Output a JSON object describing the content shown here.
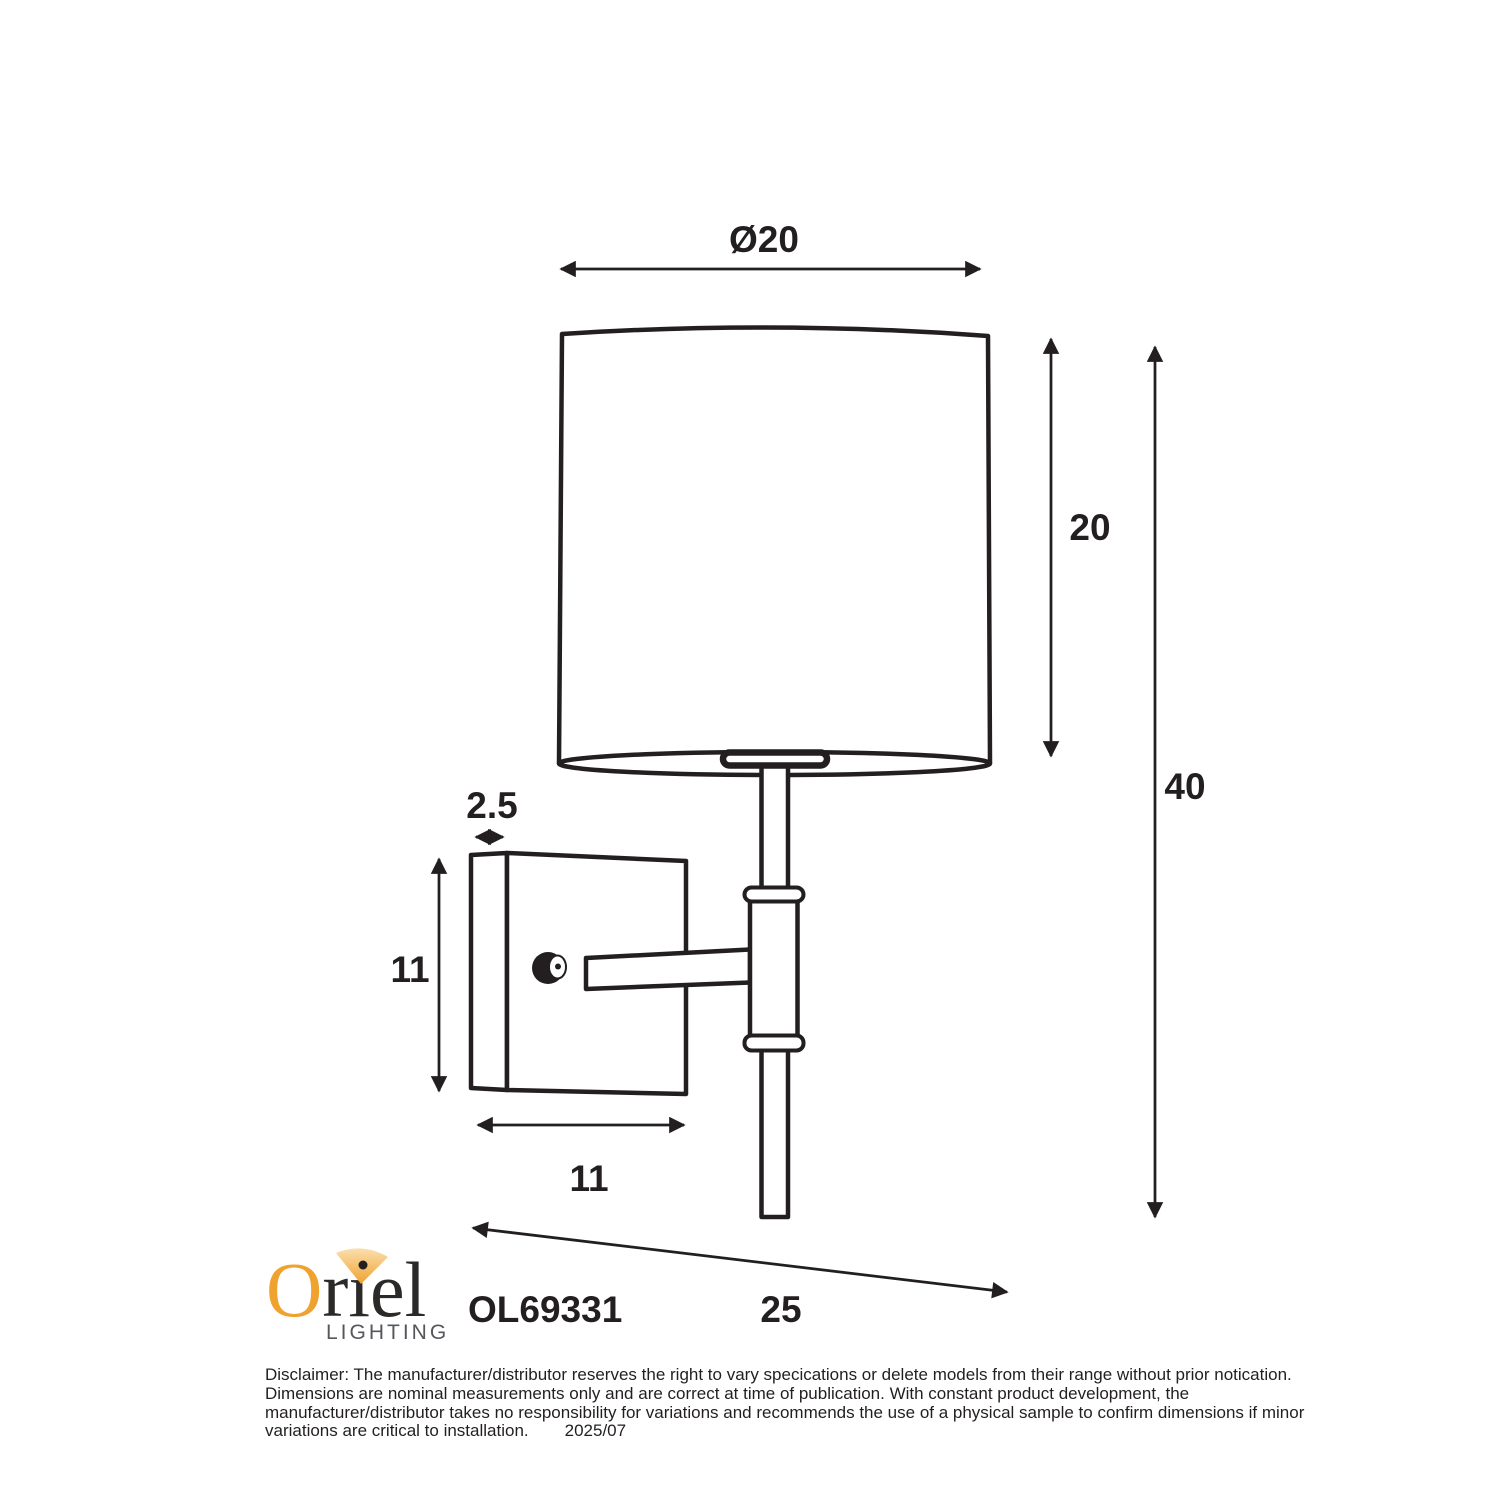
{
  "colors": {
    "ink": "#231F20",
    "background": "#FFFFFF",
    "logo_orange": "#F0A22F",
    "logo_dark": "#2B2A29",
    "logo_gray": "#56575B",
    "cone_light": "#FBDFAE",
    "cone_deep": "#F0A22F"
  },
  "labels": {
    "shade_diameter": "Ø20",
    "shade_height": "20",
    "overall_height": "40",
    "plate_depth": "2.5",
    "plate_height": "11",
    "plate_width": "11",
    "projection": "25"
  },
  "product": {
    "model": "OL69331"
  },
  "logo": {
    "brand_initial": "O",
    "brand_rest": "riel",
    "subtitle": "LIGHTING"
  },
  "disclaimer": {
    "lines": [
      "Disclaimer: The manufacturer/distributor reserves the right to vary specications or delete models from their range without prior notication.",
      "Dimensions are nominal measurements only and are correct at time of publication. With constant product development, the",
      "manufacturer/distributor takes no responsibility for variations and recommends the use of a physical sample to confirm dimensions if minor",
      "variations are critical to installation."
    ],
    "date": "2025/07"
  }
}
